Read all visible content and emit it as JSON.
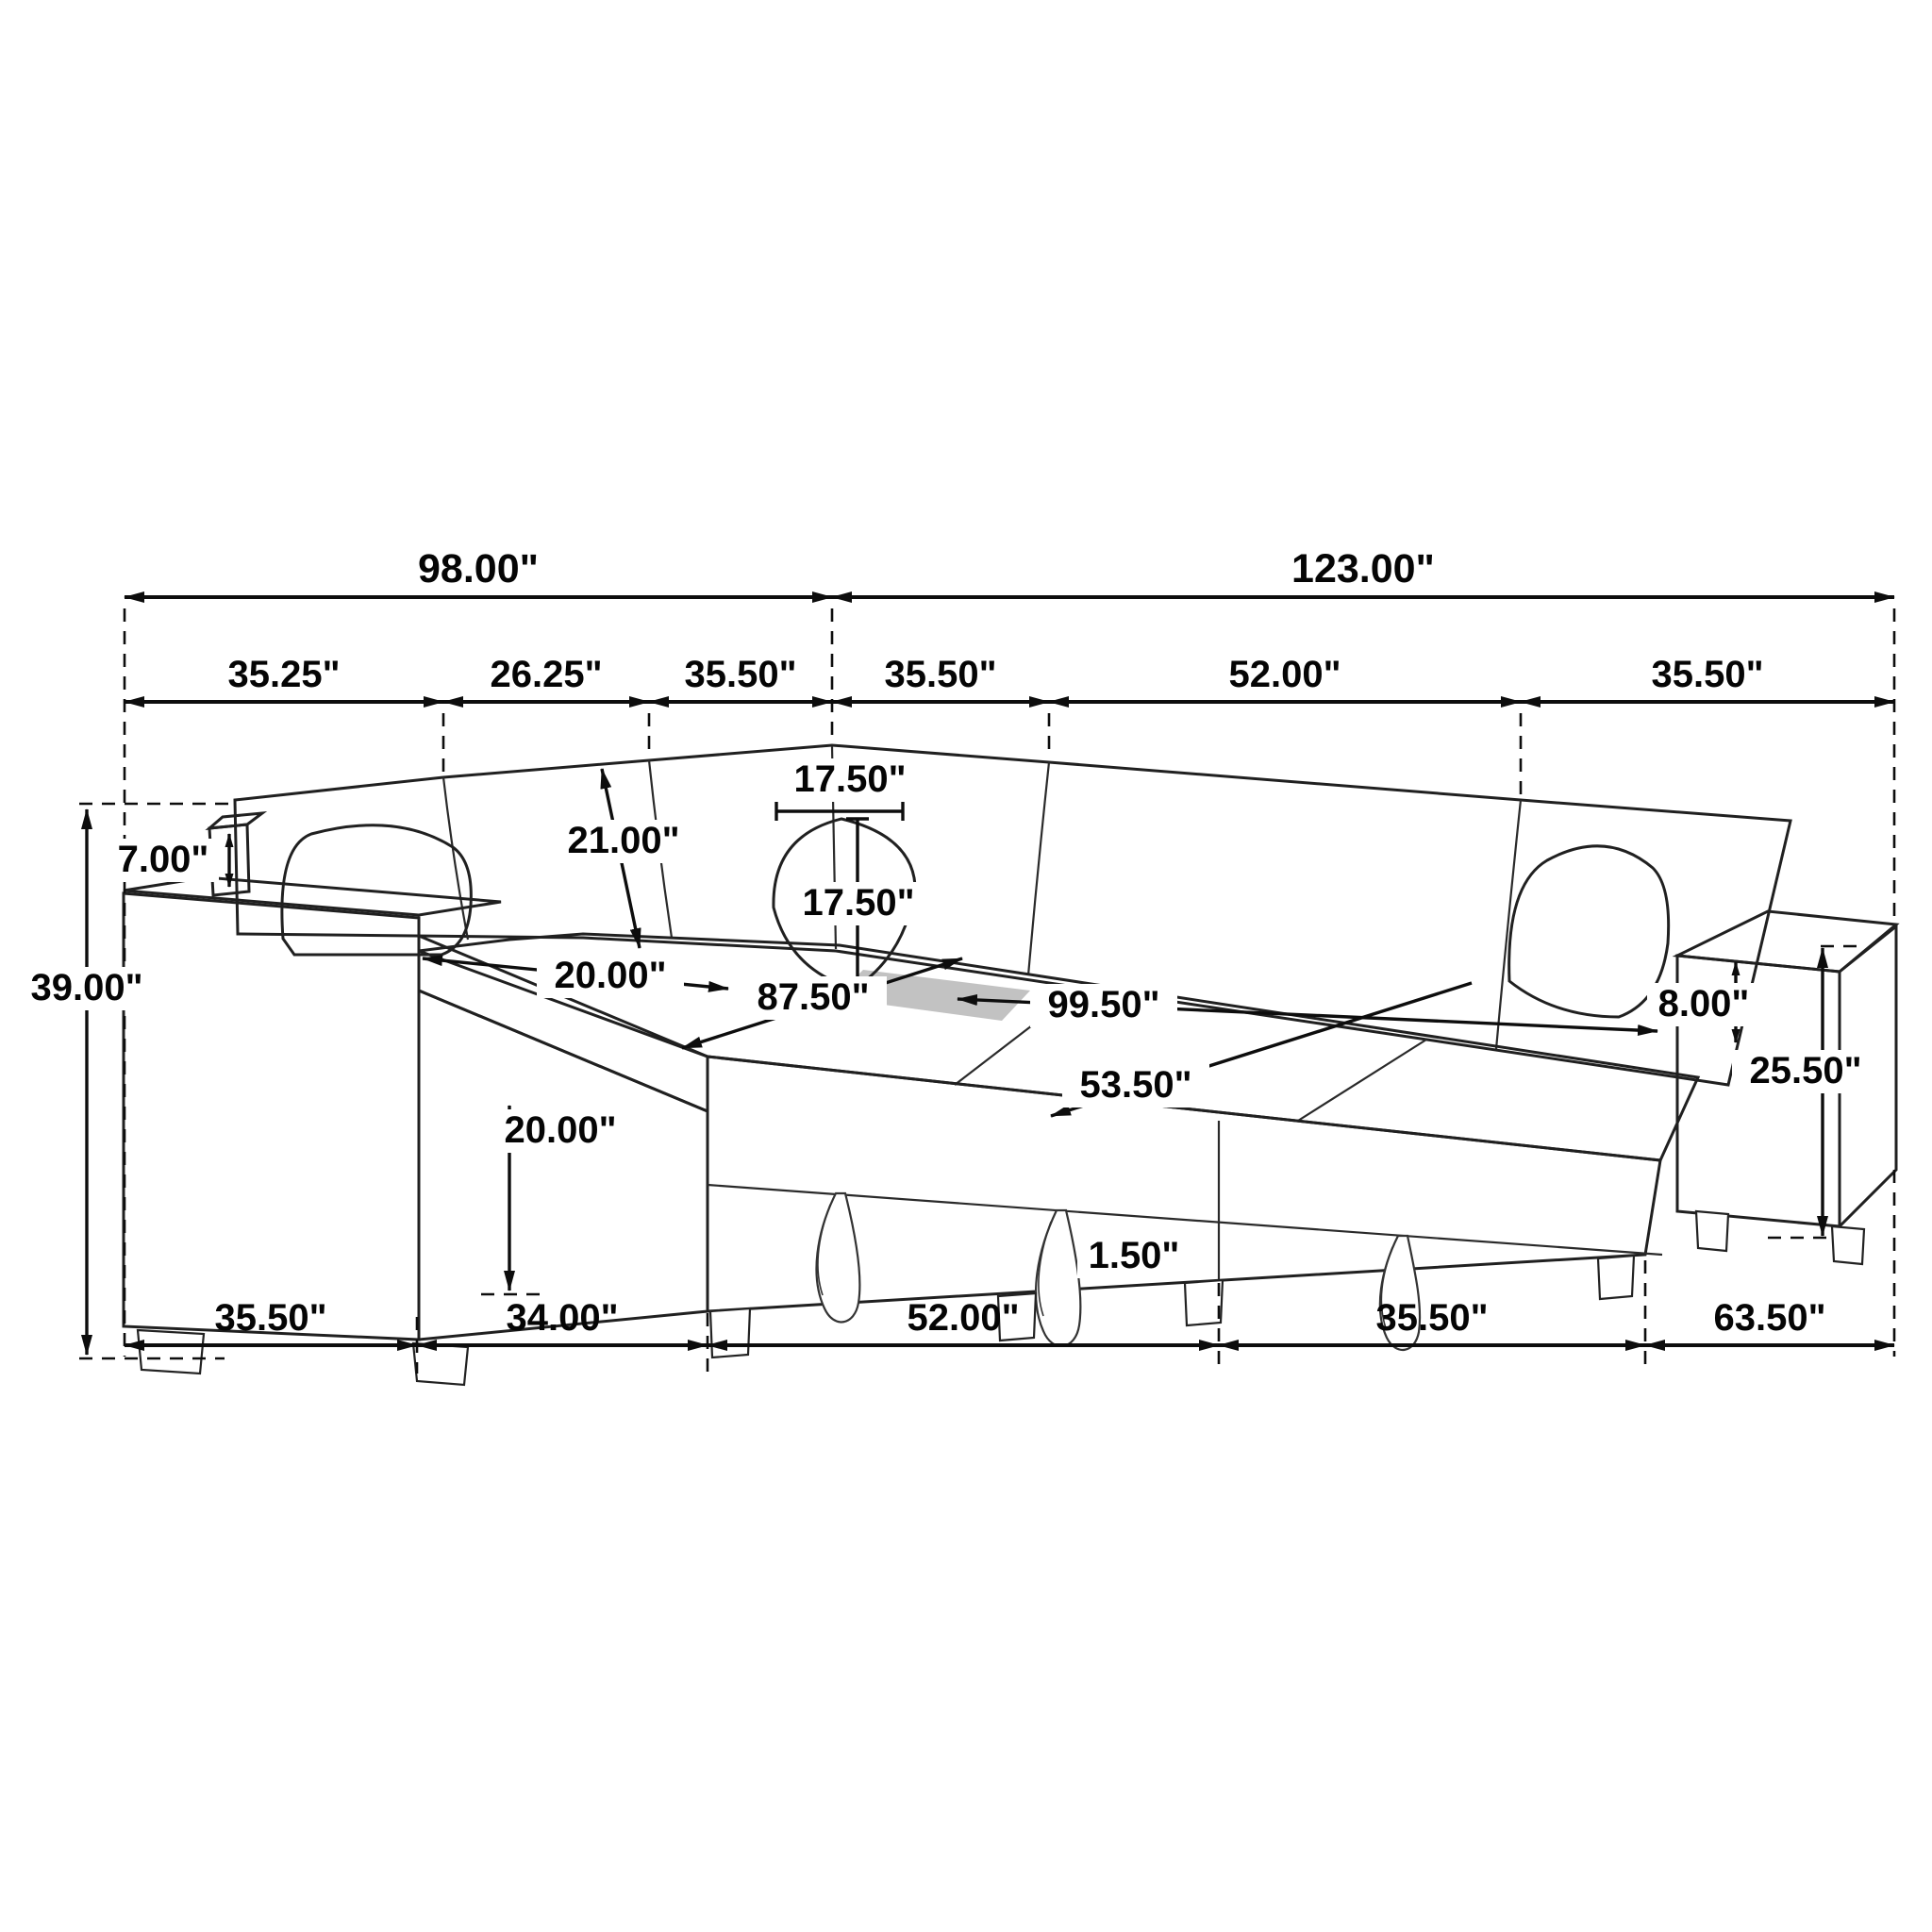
{
  "diagram": {
    "kind": "furniture-dimension-line-drawing",
    "subject": "U-shaped sectional sleeper sofa with pull-out bed, corduroy upholstery",
    "units": "inches",
    "colors": {
      "background": "#ffffff",
      "line": "#1a1a1a",
      "label_text": "#050505",
      "arm_top_shade": "#4a4a4a",
      "deck_shade_patch": "#8f8f8f"
    },
    "dims": {
      "overall_left": "98.00\"",
      "overall_right": "123.00\"",
      "top_sections": [
        "35.25\"",
        "26.25\"",
        "35.50\"",
        "35.50\"",
        "52.00\"",
        "35.50\""
      ],
      "bottom_sections": [
        "35.50\"",
        "34.00\"",
        "52.00\"",
        "35.50\"",
        "63.50\""
      ],
      "total_height": "39.00\"",
      "back_panel_above_arm": "7.00\"",
      "backrest_length": "21.00\"",
      "pillow_width": "17.50\"",
      "pillow_height": "17.50\"",
      "seat_depth": "20.00\"",
      "seat_front_height": "20.00\"",
      "bed_length_inner": "87.50\"",
      "bed_length_outer": "99.50\"",
      "bed_width": "53.50\"",
      "arm_above_seat": "8.00\"",
      "arm_total_height": "25.50\"",
      "ground_clearance": "1.50\""
    }
  }
}
